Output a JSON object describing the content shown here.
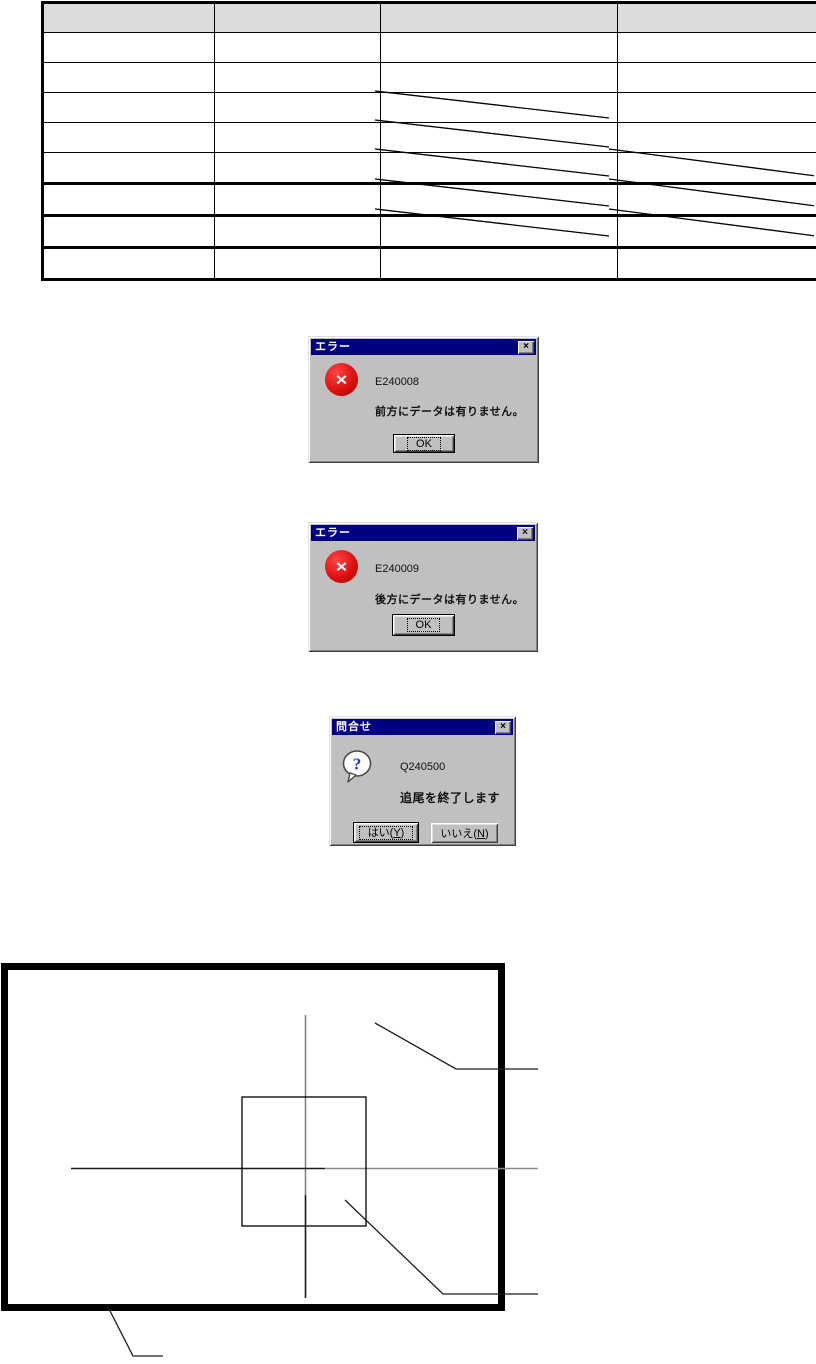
{
  "colors": {
    "titlebar": "#000080",
    "dialog_bg": "#c0c0c0",
    "error_red": "#dd1111",
    "question_blue": "#2233cc",
    "table_header_bg": "#dcdcdc"
  },
  "icons": {
    "close_glyph": "×",
    "error_glyph": "×",
    "question_glyph": "?"
  },
  "table": {
    "col_widths": [
      168,
      163,
      234,
      207
    ],
    "header_height": 29,
    "row_height": 29,
    "columns": [
      "",
      "",
      "",
      ""
    ],
    "rows": [
      {
        "cells": [
          "",
          "",
          "",
          ""
        ],
        "na": [],
        "thick_bottom": false
      },
      {
        "cells": [
          "",
          "",
          "",
          ""
        ],
        "na": [],
        "thick_bottom": false
      },
      {
        "cells": [
          "",
          "",
          "",
          ""
        ],
        "na": [
          2
        ],
        "thick_bottom": false
      },
      {
        "cells": [
          "",
          "",
          "",
          ""
        ],
        "na": [
          2
        ],
        "thick_bottom": false
      },
      {
        "cells": [
          "",
          "",
          "",
          ""
        ],
        "na": [
          2,
          3
        ],
        "thick_bottom": true
      },
      {
        "cells": [
          "",
          "",
          "",
          ""
        ],
        "na": [
          2,
          3
        ],
        "thick_bottom": true
      },
      {
        "cells": [
          "",
          "",
          "",
          ""
        ],
        "na": [
          2,
          3
        ],
        "thick_bottom": true
      },
      {
        "cells": [
          "",
          "",
          "",
          ""
        ],
        "na": [],
        "thick_bottom": false
      }
    ]
  },
  "dialogs": {
    "error_forward": {
      "title": "エラー",
      "code": "E240008",
      "message": "前方にデータは有りません。",
      "ok_label": "OK"
    },
    "error_backward": {
      "title": "エラー",
      "code": "E240009",
      "message": "後方にデータは有りません。",
      "ok_label": "OK"
    },
    "confirm_end_tracking": {
      "title": "問合せ",
      "code": "Q240500",
      "message": "追尾を終了します",
      "yes": {
        "pre": "はい(",
        "key": "Y",
        "post": ")"
      },
      "no": {
        "pre": "いいえ(",
        "key": "N",
        "post": ")"
      }
    }
  }
}
